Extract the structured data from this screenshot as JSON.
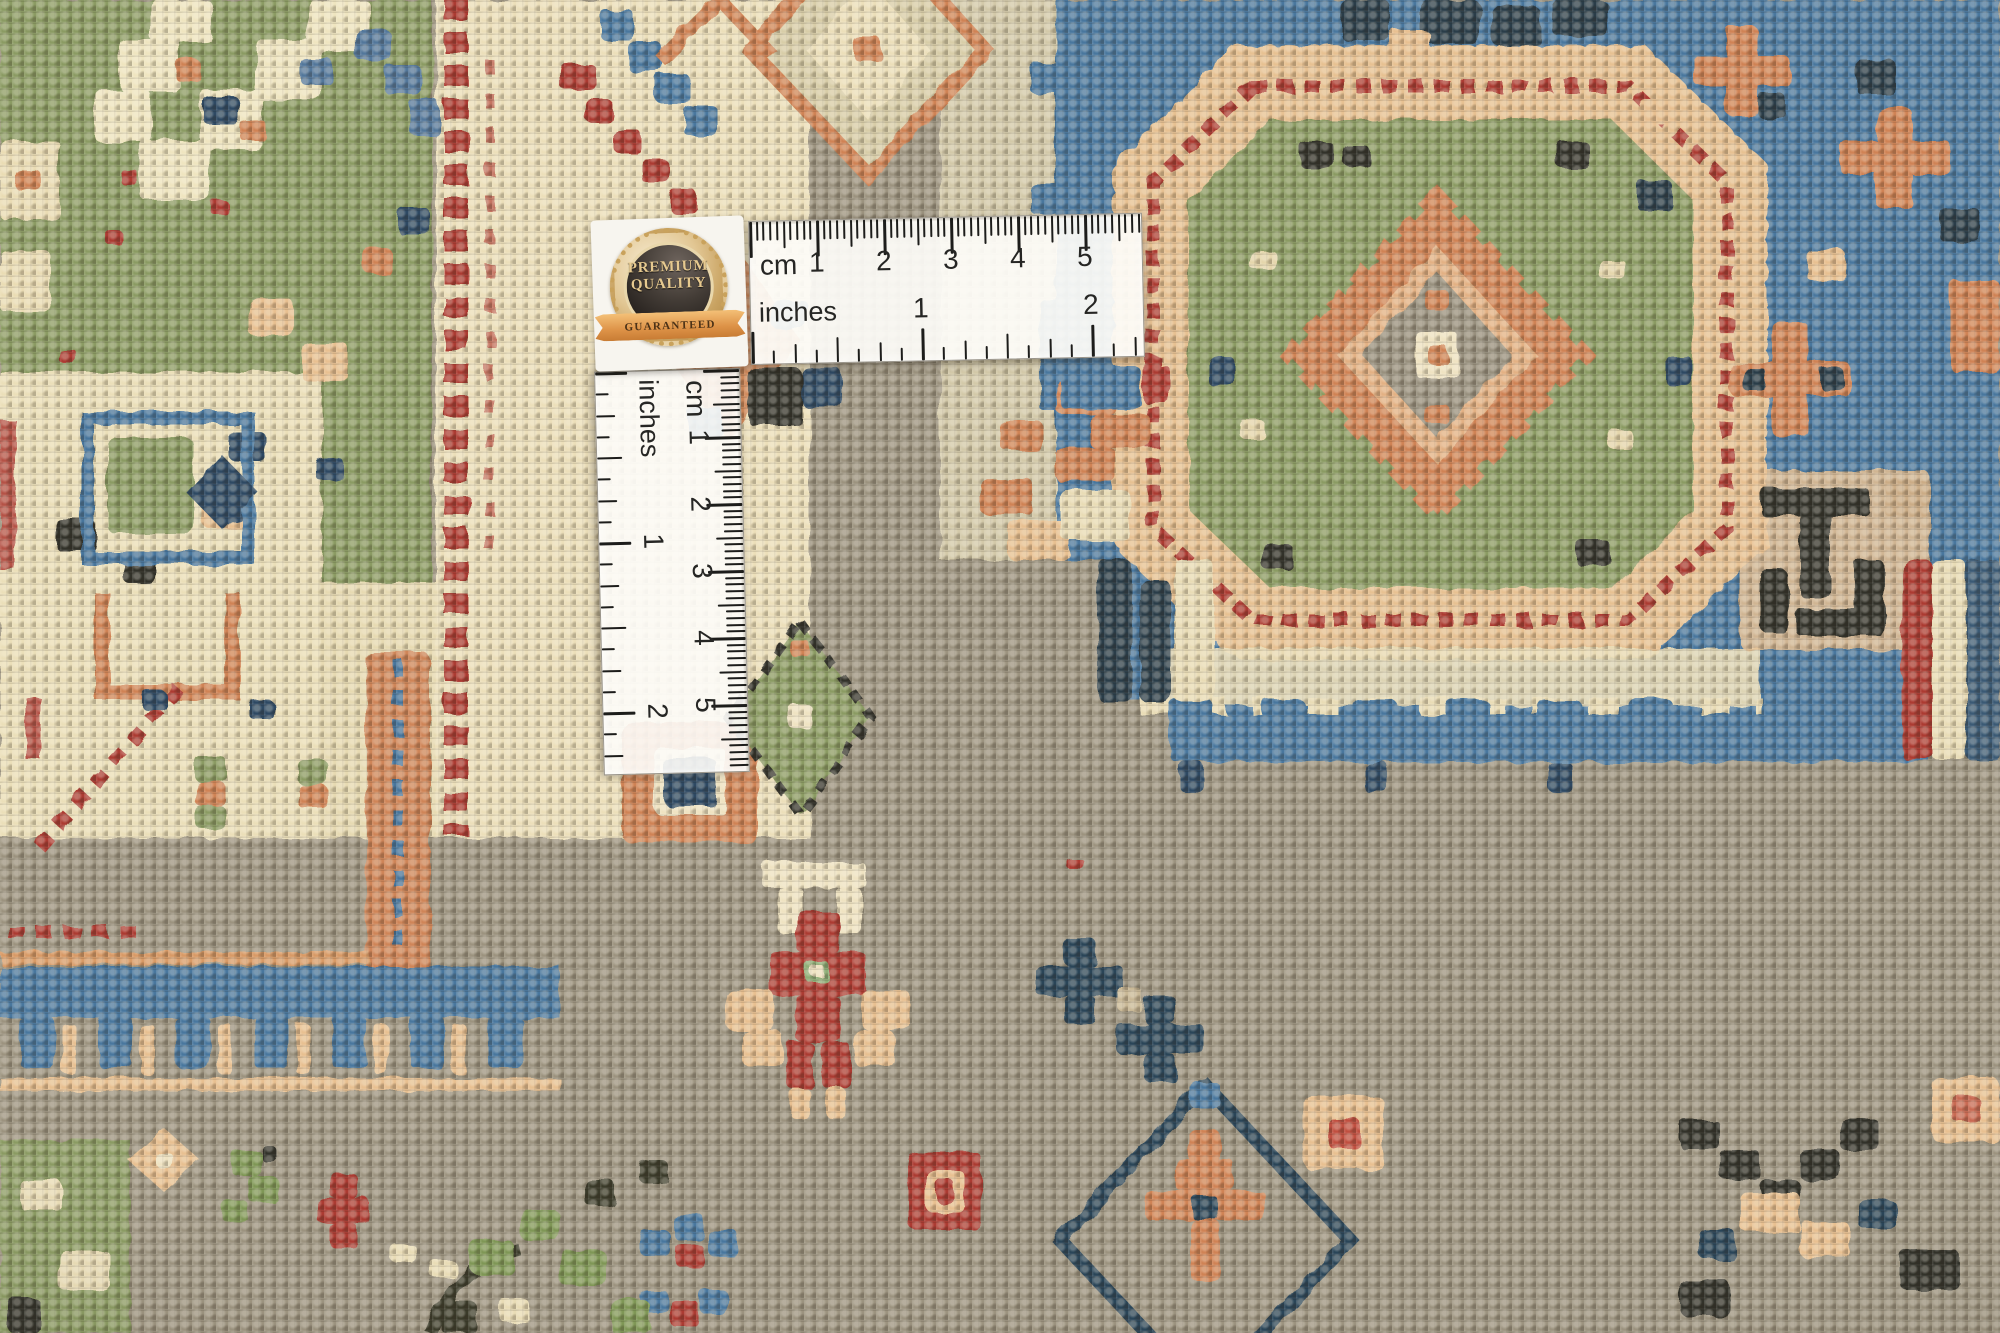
{
  "badge": {
    "premium": "PREMIUM",
    "quality": "QUALITY",
    "guaranteed": "GUARANTEED"
  },
  "rulers": {
    "cm_label": "cm",
    "inches_label": "inches",
    "cm_numbers": [
      "1",
      "2",
      "3",
      "4",
      "5"
    ],
    "inch_numbers": [
      "1",
      "2"
    ]
  },
  "palette": {
    "field_taupe": "#9c937f",
    "field_green": "#8b9b63",
    "cream": "#ebdfb9",
    "blue": "#4a779e",
    "navy": "#2d4a63",
    "red": "#ac3a32",
    "salmon": "#d08354",
    "peach": "#e8c091",
    "dark_brown": "#33302a",
    "ruler_white": "#fdfcf8",
    "tick_black": "#1d1d1b",
    "badge_gold": "#c8a261",
    "ribbon_orange": "#dd9247"
  }
}
